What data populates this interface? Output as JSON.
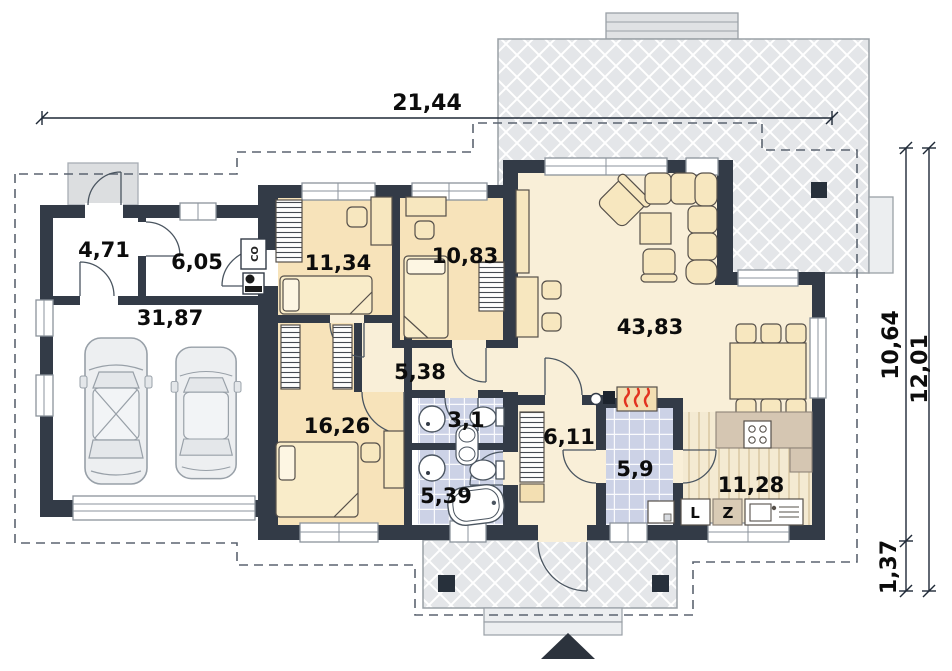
{
  "plan": {
    "dimensions": {
      "width_total": "21,44",
      "height_inner": "10,64",
      "height_total": "12,01",
      "height_porch": "1,37"
    },
    "rooms": [
      {
        "name": "vestibule",
        "area": "4,71"
      },
      {
        "name": "tech-room",
        "area": "6,05"
      },
      {
        "name": "garage",
        "area": "31,87"
      },
      {
        "name": "bedroom-1",
        "area": "11,34"
      },
      {
        "name": "bedroom-2",
        "area": "10,83"
      },
      {
        "name": "living-room",
        "area": "43,83"
      },
      {
        "name": "corridor",
        "area": "5,38"
      },
      {
        "name": "bedroom-3",
        "area": "16,26"
      },
      {
        "name": "bathroom-small",
        "area": "3,1"
      },
      {
        "name": "bathroom",
        "area": "5,39"
      },
      {
        "name": "hall",
        "area": "6,11"
      },
      {
        "name": "utility",
        "area": "5,9"
      },
      {
        "name": "kitchen",
        "area": "11,28"
      }
    ],
    "labels": {
      "boiler": "CO",
      "fridge": "L",
      "dishwasher": "Z"
    },
    "colors": {
      "wall": "#333b47",
      "bedroom_floor": "#f7e3ba",
      "living_floor": "#f9efd8",
      "bath_tile": "#ccd2e6",
      "terrace": "#e4e6e9",
      "kitchen_counter": "#d5c6b2",
      "furniture": "#f7e7bf",
      "flame": "#e2331f"
    }
  }
}
